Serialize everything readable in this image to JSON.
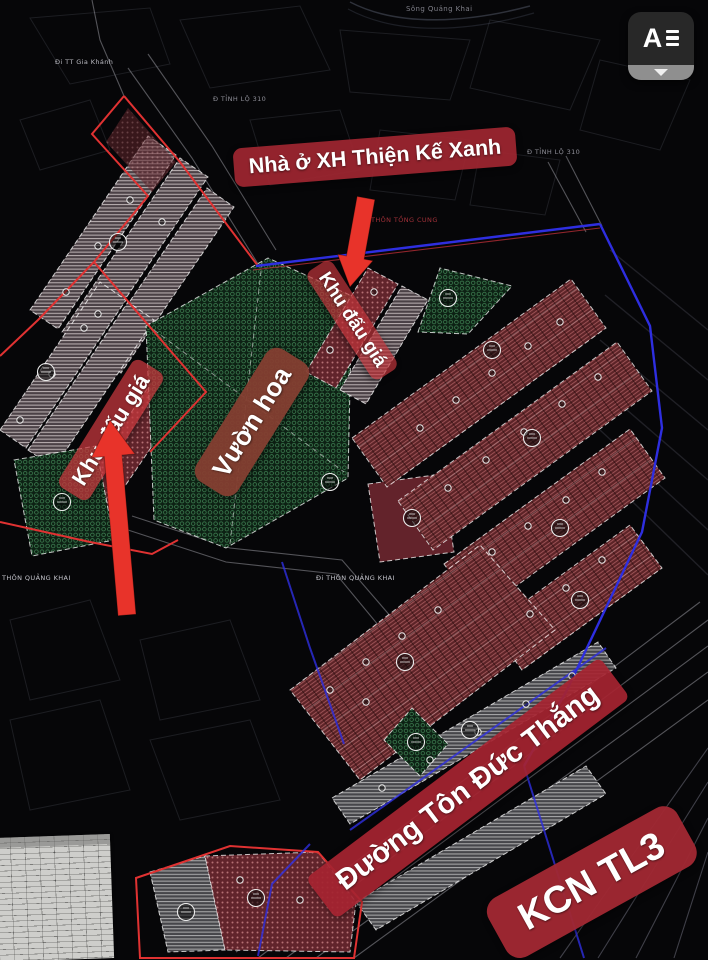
{
  "overlay_widget": {
    "logo_letter": "A",
    "menu_icon": "hamburger-bars",
    "dropdown_glyph": "▼"
  },
  "annotations": {
    "social_housing": "Nhà ở XH Thiện Kế Xanh",
    "auction_area_right": "Khu đấu giá",
    "auction_area_left": "Khu đấu giá",
    "flower_garden": "Vườn hoa",
    "road_name": "Đường Tôn Đức Thắng",
    "industrial_zone": "KCN TL3"
  },
  "map_texts": {
    "river": "Sông Quảng Khai",
    "to_gia_khanh": "Đi TT Gia Khánh",
    "provincial_road_left": "Đ TỈNH LỘ 310",
    "provincial_road_right": "Đ TỈNH LỘ 310",
    "hamlet_tong_cung": "THÔN TỒNG CUNG",
    "hamlet_quang_khai": "THÔN QUẢNG KHAI",
    "to_quang_khai": "Đi THÔN QUẢNG KHAI"
  },
  "colors": {
    "annotation_red": "#9e2630",
    "arrow_red": "#e8332a",
    "garden_green": "#2e7d46",
    "boundary_blue": "#2e2ee0",
    "boundary_red": "#e03232",
    "parcel_red": "#5c2327"
  }
}
